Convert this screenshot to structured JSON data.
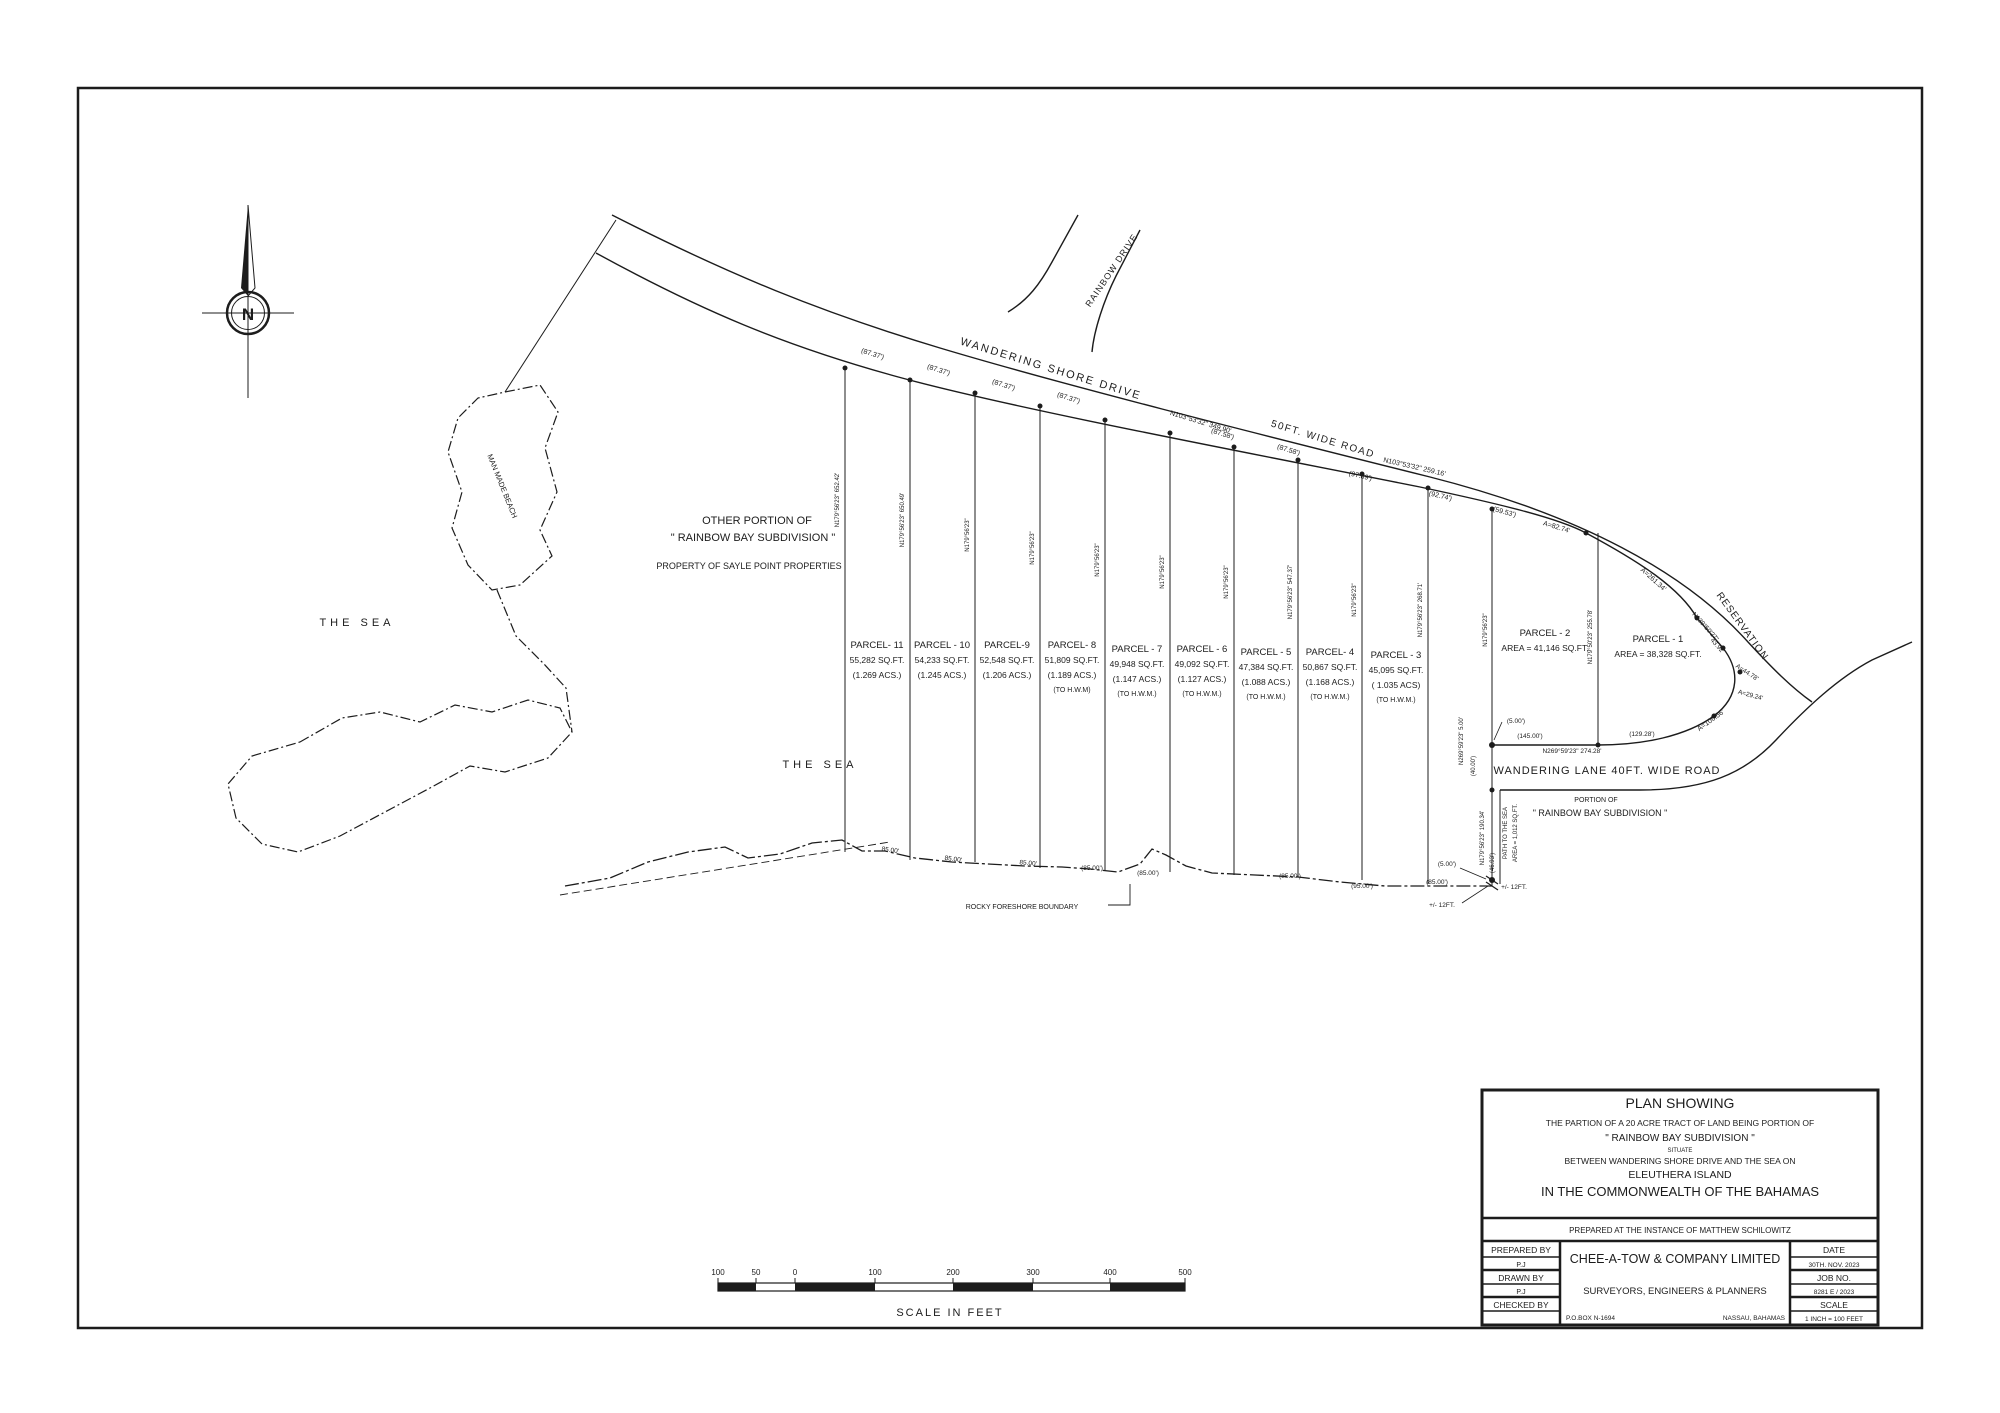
{
  "drawing": {
    "compass_n": "N",
    "title_block": {
      "title": "PLAN SHOWING",
      "line1": "THE PARTION OF A 20 ACRE TRACT OF LAND BEING PORTION OF",
      "line2": "\" RAINBOW BAY SUBDIVISION \"",
      "line3": "SITUATE",
      "line4": "BETWEEN WANDERING SHORE DRIVE AND THE SEA ON",
      "line5": "ELEUTHERA  ISLAND",
      "line6": "IN THE COMMONWEALTH OF THE BAHAMAS",
      "instance": "PREPARED AT THE INSTANCE OF MATTHEW SCHILOWITZ",
      "prepared_by_label": "PREPARED BY",
      "prepared_by_value": "P.J",
      "drawn_by_label": "DRAWN BY",
      "drawn_by_value": "P.J",
      "checked_by_label": "CHECKED BY",
      "checked_by_value": "",
      "company": "CHEE-A-TOW & COMPANY LIMITED",
      "company_sub": "SURVEYORS, ENGINEERS & PLANNERS",
      "po_box": "P.O.BOX N-1694",
      "city": "NASSAU, BAHAMAS",
      "date_label": "DATE",
      "date_value": "30TH. NOV. 2023",
      "job_label": "JOB NO.",
      "job_value": "8281 E / 2023",
      "scale_label": "SCALE",
      "scale_value": "1 INCH = 100 FEET"
    },
    "scale_bar": {
      "caption": "SCALE  IN  FEET",
      "ticks": [
        {
          "t": "100",
          "x": 718
        },
        {
          "t": "50",
          "x": 756
        },
        {
          "t": "0",
          "x": 795
        },
        {
          "t": "100",
          "x": 875
        },
        {
          "t": "200",
          "x": 953
        },
        {
          "t": "300",
          "x": 1033
        },
        {
          "t": "400",
          "x": 1110
        },
        {
          "t": "500",
          "x": 1185
        }
      ]
    },
    "parcels": [
      {
        "name": "PARCEL- 11",
        "area": "55,282 SQ.FT.",
        "acres": "(1.269 ACS.)",
        "hwm": "",
        "cx": 877,
        "ly": 648
      },
      {
        "name": "PARCEL - 10",
        "area": "54,233 SQ.FT.",
        "acres": "(1.245 ACS.)",
        "hwm": "",
        "cx": 942,
        "ly": 648
      },
      {
        "name": "PARCEL-9",
        "area": "52,548 SQ.FT.",
        "acres": "(1.206 ACS.)",
        "hwm": "",
        "cx": 1007,
        "ly": 648
      },
      {
        "name": "PARCEL- 8",
        "area": "51,809  SQ.FT.",
        "acres": "(1.189 ACS.)",
        "hwm": "(TO H.W.M)",
        "cx": 1072,
        "ly": 648
      },
      {
        "name": "PARCEL - 7",
        "area": "49,948 SQ.FT.",
        "acres": "(1.147 ACS.)",
        "hwm": "(TO H.W.M.)",
        "cx": 1137,
        "ly": 652
      },
      {
        "name": "PARCEL - 6",
        "area": "49,092 SQ.FT.",
        "acres": "(1.127 ACS.)",
        "hwm": "(TO H.W.M.)",
        "cx": 1202,
        "ly": 652
      },
      {
        "name": "PARCEL - 5",
        "area": "47,384 SQ.FT.",
        "acres": "(1.088 ACS.)",
        "hwm": "(TO H.W.M.)",
        "cx": 1266,
        "ly": 655
      },
      {
        "name": "PARCEL- 4",
        "area": "50,867 SQ.FT.",
        "acres": "(1.168 ACS.)",
        "hwm": "(TO H.W.M.)",
        "cx": 1330,
        "ly": 655
      },
      {
        "name": "PARCEL - 3",
        "area": "45,095 SQ.FT.",
        "acres": "( 1.035 ACS)",
        "hwm": "(TO H.W.M.)",
        "cx": 1396,
        "ly": 658
      },
      {
        "name": "PARCEL - 2",
        "area": "AREA = 41,146 SQ.FT.",
        "acres": "",
        "hwm": "",
        "cx": 1545,
        "ly": 636
      },
      {
        "name": "PARCEL  -  1",
        "area": "AREA = 38,328 SQ.FT.",
        "acres": "",
        "hwm": "",
        "cx": 1658,
        "ly": 642
      }
    ],
    "labels": [
      {
        "n": "wandering-shore-drive-label",
        "t": "WANDERING SHORE DRIVE",
        "x": 1050,
        "y": 372,
        "r": 17,
        "s": 11,
        "ls": 2
      },
      {
        "n": "fifty-ft-wide-road-label",
        "t": "50FT. WIDE ROAD",
        "x": 1322,
        "y": 442,
        "r": 17,
        "s": 10,
        "ls": 1.5
      },
      {
        "n": "rainbow-drive-label",
        "t": "RAINBOW DRIVE",
        "x": 1114,
        "y": 272,
        "r": -56,
        "s": 9,
        "ls": 1
      },
      {
        "n": "wandering-lane-label",
        "t": "WANDERING LANE 40FT. WIDE ROAD",
        "x": 1607,
        "y": 774,
        "r": 0,
        "s": 11,
        "ls": 1
      },
      {
        "n": "reservation-label",
        "t": "RESERVATION",
        "x": 1740,
        "y": 628,
        "r": 54,
        "s": 10,
        "ls": 1
      },
      {
        "n": "road-bearing-349",
        "t": "N103°53'32\"  349.90'",
        "x": 1200,
        "y": 424,
        "r": 17,
        "s": 7
      },
      {
        "n": "frontage-dim",
        "t": "(87.37')",
        "x": 872,
        "y": 356,
        "r": 17,
        "s": 7
      },
      {
        "n": "frontage-dim",
        "t": "(87.37')",
        "x": 938,
        "y": 372,
        "r": 17,
        "s": 7
      },
      {
        "n": "frontage-dim",
        "t": "(87.37')",
        "x": 1003,
        "y": 387,
        "r": 17,
        "s": 7
      },
      {
        "n": "frontage-dim",
        "t": "(87.37')",
        "x": 1068,
        "y": 400,
        "r": 17,
        "s": 7
      },
      {
        "n": "frontage-dim",
        "t": "(87.58')",
        "x": 1222,
        "y": 436,
        "r": 17,
        "s": 7
      },
      {
        "n": "frontage-dim",
        "t": "(87.58')",
        "x": 1288,
        "y": 452,
        "r": 17,
        "s": 7
      },
      {
        "n": "frontage-dim",
        "t": "(97.89')",
        "x": 1360,
        "y": 478,
        "r": 13,
        "s": 7
      },
      {
        "n": "road-bearing-259",
        "t": "N103°53'32\"  259.16'",
        "x": 1414,
        "y": 469,
        "r": 13,
        "s": 7
      },
      {
        "n": "frontage-dim",
        "t": "(92.74')",
        "x": 1440,
        "y": 498,
        "r": 13,
        "s": 7
      },
      {
        "n": "frontage-dim",
        "t": "(59.53')",
        "x": 1504,
        "y": 514,
        "r": 15,
        "s": 7
      },
      {
        "n": "curve-dim",
        "t": "A=82.74'",
        "x": 1556,
        "y": 529,
        "r": 17,
        "s": 7
      },
      {
        "n": "curve-dim",
        "t": "A=261.34'",
        "x": 1652,
        "y": 581,
        "r": 42,
        "s": 7
      },
      {
        "n": "chord-bearing",
        "t": "N139°50'27\"",
        "x": 1704,
        "y": 628,
        "r": 48,
        "s": 6.5
      },
      {
        "n": "chord-dim",
        "t": "43.92'",
        "x": 1716,
        "y": 647,
        "r": 48,
        "s": 6.5
      },
      {
        "n": "curve-dim",
        "t": "A=44.78'",
        "x": 1746,
        "y": 674,
        "r": 33,
        "s": 6.5
      },
      {
        "n": "curve-dim",
        "t": "A=29.24'",
        "x": 1750,
        "y": 697,
        "r": 15,
        "s": 6.5
      },
      {
        "n": "curve-dim",
        "t": "A=106.56'",
        "x": 1712,
        "y": 722,
        "r": -36,
        "s": 7
      },
      {
        "n": "lane-dim",
        "t": "(5.00')",
        "x": 1516,
        "y": 723,
        "r": 0,
        "s": 6.5
      },
      {
        "n": "lane-dim",
        "t": "(145.00')",
        "x": 1530,
        "y": 738,
        "r": 0,
        "s": 6.5
      },
      {
        "n": "lane-dim",
        "t": "(129.28')",
        "x": 1642,
        "y": 736,
        "r": 0,
        "s": 6.5
      },
      {
        "n": "lane-bearing",
        "t": "N269°59'23\"  274.28'",
        "x": 1572,
        "y": 753,
        "r": 0,
        "s": 6.5
      },
      {
        "n": "portion-of-label",
        "t": "PORTION OF",
        "x": 1596,
        "y": 802,
        "r": 0,
        "s": 7
      },
      {
        "n": "portion-subdivision-label",
        "t": "\" RAINBOW BAY SUBDIVISION \"",
        "x": 1600,
        "y": 816,
        "r": 0,
        "s": 9
      },
      {
        "n": "lane-end-bearing",
        "t": "N269°59'23\" 5.00'",
        "x": 1463,
        "y": 741,
        "r": -90,
        "s": 6
      },
      {
        "n": "lane-end-dim",
        "t": "(40.00')",
        "x": 1475,
        "y": 766,
        "r": -90,
        "s": 6
      },
      {
        "n": "path-bearing",
        "t": "N179°56'23\" 190.34'",
        "x": 1484,
        "y": 838,
        "r": -90,
        "s": 6
      },
      {
        "n": "path-label",
        "t": "PATH TO THE SEA",
        "x": 1507,
        "y": 833,
        "r": -90,
        "s": 6
      },
      {
        "n": "path-area-label",
        "t": "AREA = 1,012 SQ.FT.",
        "x": 1517,
        "y": 833,
        "r": -90,
        "s": 6
      },
      {
        "n": "path-dim",
        "t": "(46.93')",
        "x": 1494,
        "y": 863,
        "r": -90,
        "s": 6
      },
      {
        "n": "shore-dim",
        "t": "85.00'",
        "x": 890,
        "y": 852,
        "r": 8,
        "s": 6.5
      },
      {
        "n": "shore-dim",
        "t": "85.00'",
        "x": 953,
        "y": 861,
        "r": 8,
        "s": 6.5
      },
      {
        "n": "shore-dim",
        "t": "85.00'",
        "x": 1028,
        "y": 865,
        "r": 5,
        "s": 6.5
      },
      {
        "n": "shore-dim",
        "t": "(85.00')",
        "x": 1092,
        "y": 870,
        "r": 0,
        "s": 6.5
      },
      {
        "n": "shore-dim",
        "t": "(85.00')",
        "x": 1148,
        "y": 875,
        "r": 0,
        "s": 6.5
      },
      {
        "n": "shore-dim",
        "t": "(85.00')",
        "x": 1290,
        "y": 878,
        "r": 0,
        "s": 6.5
      },
      {
        "n": "shore-dim",
        "t": "(95.00')",
        "x": 1362,
        "y": 888,
        "r": 0,
        "s": 6.5
      },
      {
        "n": "shore-dim",
        "t": "(85.00')",
        "x": 1437,
        "y": 884,
        "r": 0,
        "s": 6.5
      },
      {
        "n": "shore-dim",
        "t": "(5.00')",
        "x": 1447,
        "y": 866,
        "r": 0,
        "s": 6.5
      },
      {
        "n": "shore-note",
        "t": "+/- 12FT.",
        "x": 1442,
        "y": 907,
        "r": 0,
        "s": 6.5
      },
      {
        "n": "shore-note",
        "t": "+/- 12FT.",
        "x": 1514,
        "y": 889,
        "r": 0,
        "s": 6.5
      },
      {
        "n": "rocky-foreshore-label",
        "t": "ROCKY FORESHORE BOUNDARY",
        "x": 1022,
        "y": 909,
        "r": 0,
        "s": 7
      },
      {
        "n": "side-bearing",
        "t": "N179°56'23\" 652.42'",
        "x": 839,
        "y": 500,
        "r": -90,
        "s": 6
      },
      {
        "n": "side-bearing",
        "t": "N179°56'23\" 650.49'",
        "x": 904,
        "y": 520,
        "r": -90,
        "s": 6
      },
      {
        "n": "side-bearing",
        "t": "N179°56'23\"",
        "x": 969,
        "y": 535,
        "r": -90,
        "s": 6
      },
      {
        "n": "side-bearing",
        "t": "N179°56'23\"",
        "x": 1034,
        "y": 548,
        "r": -90,
        "s": 6
      },
      {
        "n": "side-bearing",
        "t": "N179°56'23\"",
        "x": 1099,
        "y": 560,
        "r": -90,
        "s": 6
      },
      {
        "n": "side-bearing",
        "t": "N179°56'23\"",
        "x": 1164,
        "y": 572,
        "r": -90,
        "s": 6
      },
      {
        "n": "side-bearing",
        "t": "N179°56'23\"",
        "x": 1228,
        "y": 582,
        "r": -90,
        "s": 6
      },
      {
        "n": "side-bearing",
        "t": "N179°56'23\" 547.37'",
        "x": 1292,
        "y": 592,
        "r": -90,
        "s": 6
      },
      {
        "n": "side-bearing",
        "t": "N179°56'23\"",
        "x": 1356,
        "y": 600,
        "r": -90,
        "s": 6
      },
      {
        "n": "side-bearing",
        "t": "N179°56'23\" 268.71'",
        "x": 1422,
        "y": 610,
        "r": -90,
        "s": 6
      },
      {
        "n": "side-bearing",
        "t": "N179°56'23\"",
        "x": 1487,
        "y": 630,
        "r": -90,
        "s": 6
      },
      {
        "n": "side-bearing",
        "t": "N179°50'23\"  255.78'",
        "x": 1592,
        "y": 637,
        "r": -90,
        "s": 6
      },
      {
        "n": "other-portion-line1",
        "t": "OTHER PORTION OF",
        "x": 757,
        "y": 524,
        "r": 0,
        "s": 11
      },
      {
        "n": "other-portion-line2",
        "t": "\" RAINBOW BAY SUBDIVISION \"",
        "x": 753,
        "y": 541,
        "r": 0,
        "s": 11
      },
      {
        "n": "sayle-point-label",
        "t": "PROPERTY OF SAYLE POINT PROPERTIES",
        "x": 749,
        "y": 569,
        "r": 0,
        "s": 9
      },
      {
        "n": "man-made-beach-label",
        "t": "MAN  MADE  BEACH",
        "x": 500,
        "y": 487,
        "r": 68,
        "s": 7.5
      },
      {
        "n": "the-sea-label",
        "t": "THE    SEA",
        "x": 357,
        "y": 626,
        "r": 0,
        "s": 11,
        "ls": 4
      },
      {
        "n": "the-sea-label",
        "t": "THE    SEA",
        "x": 820,
        "y": 768,
        "r": 0,
        "s": 11,
        "ls": 4
      }
    ]
  }
}
